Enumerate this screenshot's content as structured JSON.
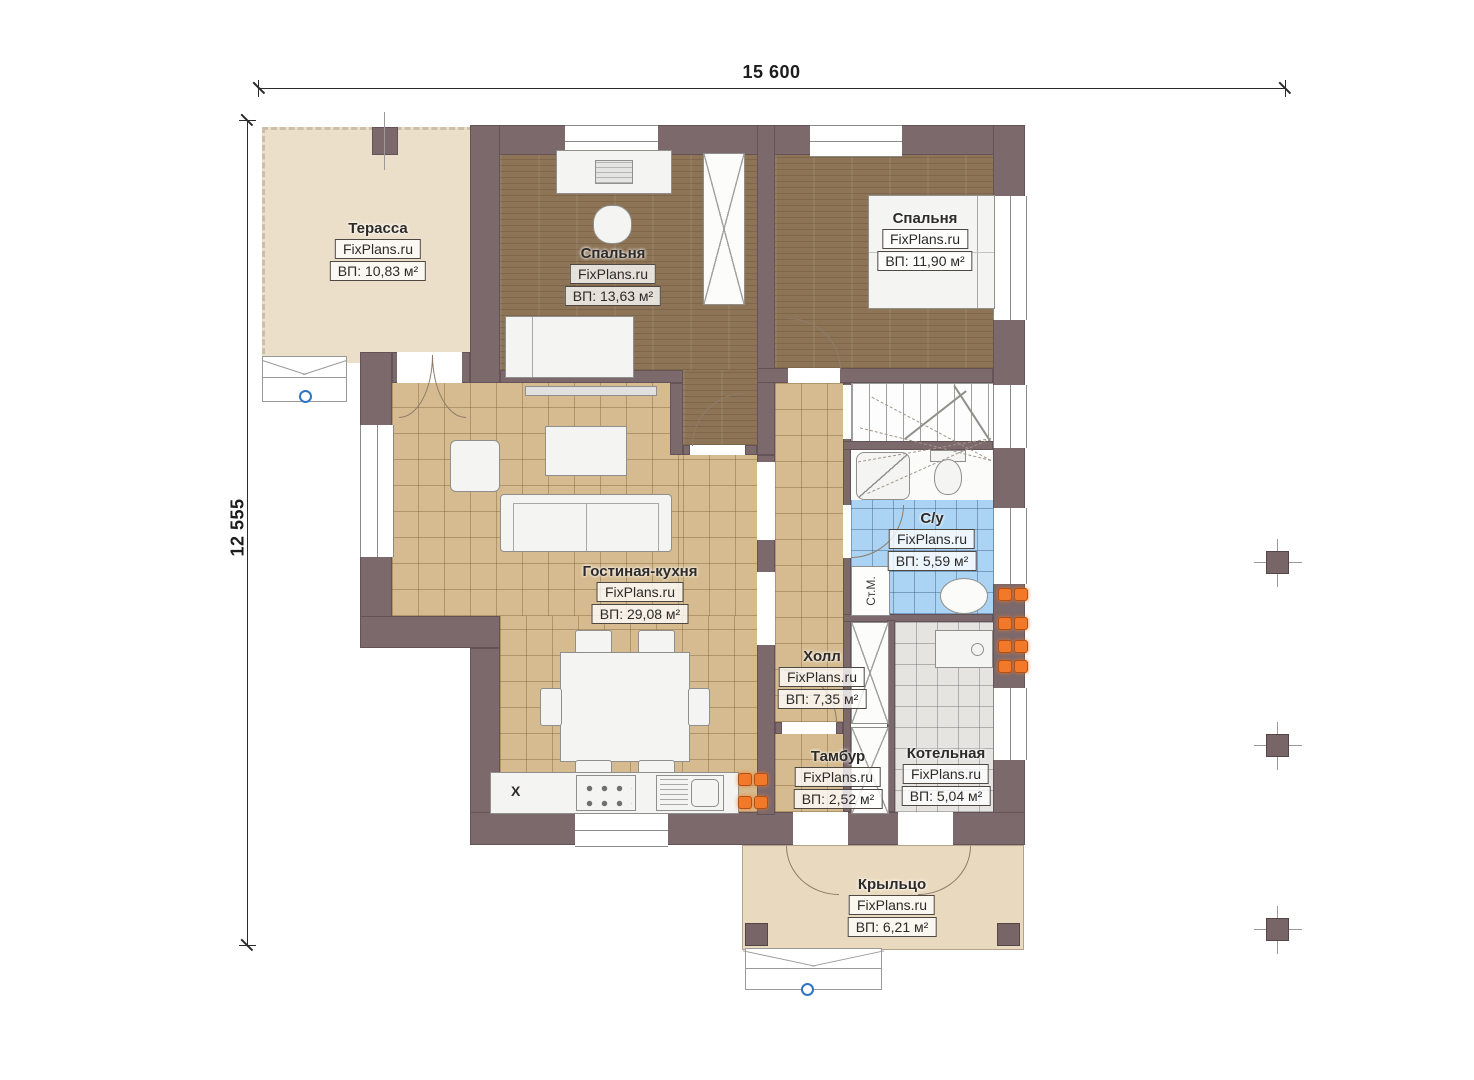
{
  "dimensions": {
    "horizontal": "15 600",
    "vertical": "12 555"
  },
  "watermark": "FixPlans.ru",
  "rooms": [
    {
      "name": "Терасса",
      "area": "ВП: 10,83 м²"
    },
    {
      "name": "Спальня",
      "area": "ВП: 13,63 м²"
    },
    {
      "name": "Спальня",
      "area": "ВП: 11,90 м²"
    },
    {
      "name": "Гостиная-кухня",
      "area": "ВП: 29,08 м²"
    },
    {
      "name": "С/у",
      "area": "ВП: 5,59 м²"
    },
    {
      "name": "Холл",
      "area": "ВП: 7,35 м²"
    },
    {
      "name": "Тамбур",
      "area": "ВП: 2,52 м²"
    },
    {
      "name": "Котельная",
      "area": "ВП: 5,04 м²"
    },
    {
      "name": "Крыльцо",
      "area": "ВП: 6,21 м²"
    }
  ],
  "annotations": {
    "washing_machine": "Ст.М.",
    "kitchen_cabinet_mark": "X"
  },
  "colors": {
    "wall": "#7b696c",
    "terrace_floor": "#ebdfc9",
    "porch_floor": "#e9dabf",
    "bedroom_floor": "#8d7456",
    "tile_floor": "#d5bb8f",
    "bath_tile": "#abd4f4",
    "boiler_tile": "#e5e4e1",
    "radiator": "#f2792a",
    "marker_blue": "#2f74c5"
  }
}
